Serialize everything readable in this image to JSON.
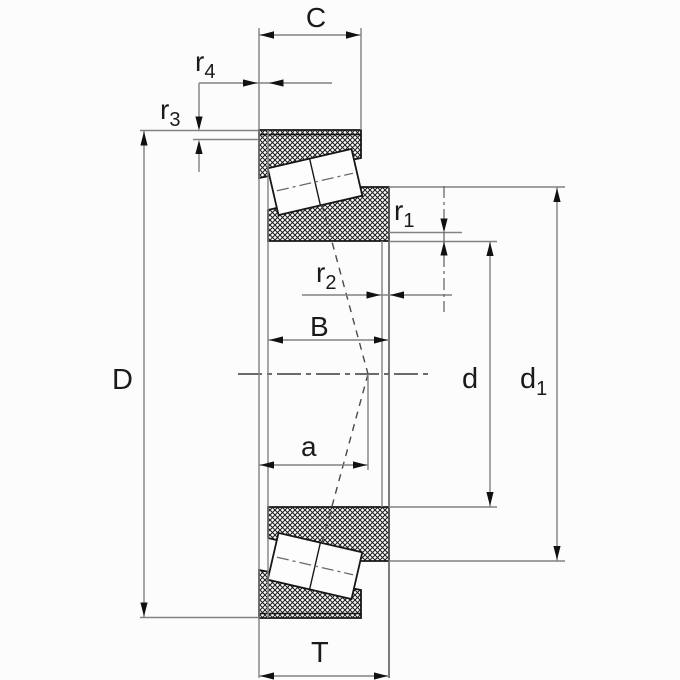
{
  "drawing": {
    "title": "Tapered roller bearing - dimension drawing",
    "background": "#fcfcfc",
    "outline_color": "#1a1a1a",
    "dimension_line_color": "#828282",
    "hatch_color": "#1a1a1a"
  },
  "labels": {
    "C": {
      "base": "C",
      "sub": ""
    },
    "r4": {
      "base": "r",
      "sub": "4"
    },
    "r3": {
      "base": "r",
      "sub": "3"
    },
    "D": {
      "base": "D",
      "sub": ""
    },
    "B": {
      "base": "B",
      "sub": ""
    },
    "r1": {
      "base": "r",
      "sub": "1"
    },
    "r2": {
      "base": "r",
      "sub": "2"
    },
    "a": {
      "base": "a",
      "sub": ""
    },
    "d": {
      "base": "d",
      "sub": ""
    },
    "d1": {
      "base": "d",
      "sub": "1"
    },
    "T": {
      "base": "T",
      "sub": ""
    }
  }
}
